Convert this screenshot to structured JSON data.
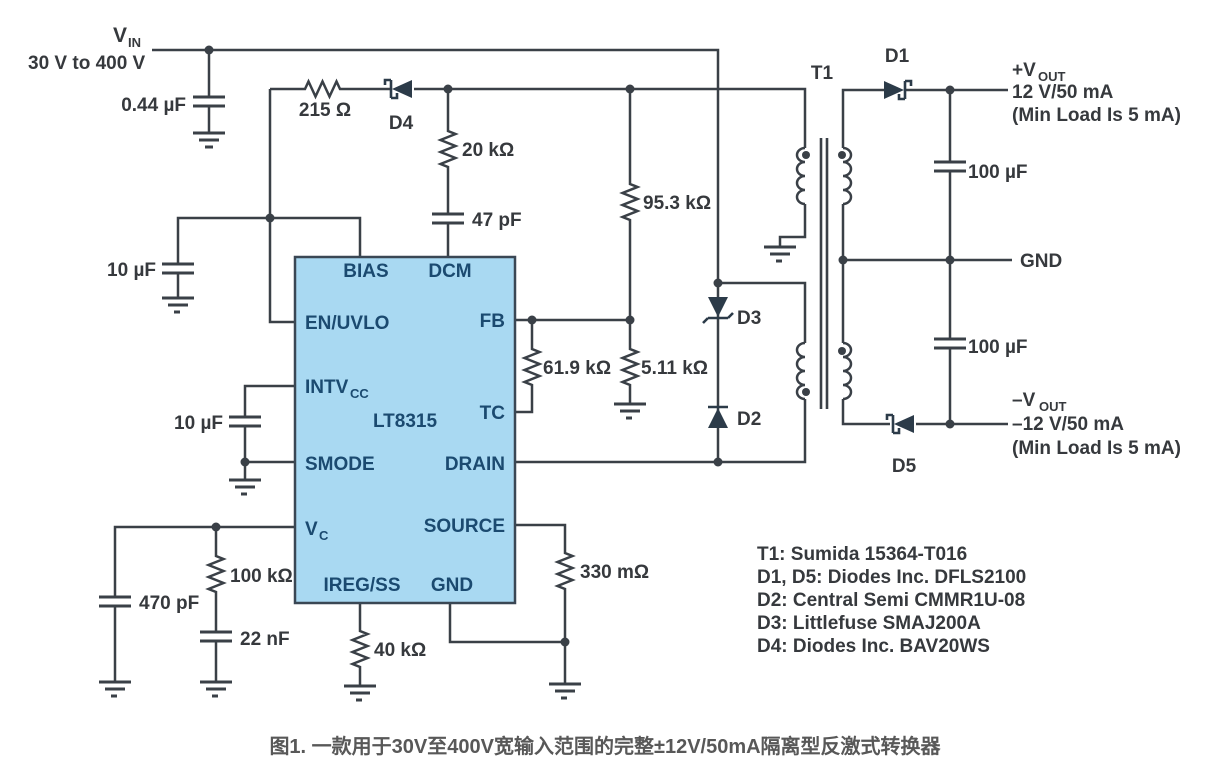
{
  "figure": {
    "caption": "图1. 一款用于30V至400V宽输入范围的完整±12V/50mA隔离型反激式转换器"
  },
  "input": {
    "vin_main": "V",
    "vin_sub": "IN",
    "vin_range": "30 V to 400 V"
  },
  "ic": {
    "part": "LT8315",
    "pins": {
      "bias": "BIAS",
      "dcm": "DCM",
      "en_uvlo": "EN/UVLO",
      "intvcc_main": "INTV",
      "intvcc_sub": "CC",
      "smode": "SMODE",
      "vc_main": "V",
      "vc_sub": "C",
      "ireg_ss": "IREG/SS",
      "gnd": "GND",
      "fb": "FB",
      "tc": "TC",
      "drain": "DRAIN",
      "source": "SOURCE"
    }
  },
  "components": {
    "c_in": "0.44 µF",
    "r_bias": "215 Ω",
    "d4": "D4",
    "r_dcm": "20 kΩ",
    "c_dcm": "47 pF",
    "r_fb_top": "95.3 kΩ",
    "c_bias": "10 µF",
    "c_intvcc": "10 µF",
    "r_tc": "61.9 kΩ",
    "r_fb_bot": "5.11 kΩ",
    "c_vc_hf": "470 pF",
    "r_vc": "100 kΩ",
    "c_vc": "22 nF",
    "r_ireg": "40 kΩ",
    "r_sense": "330 mΩ",
    "d3": "D3",
    "d2": "D2",
    "t1": "T1",
    "d1": "D1",
    "d5": "D5",
    "c_out_pos": "100 µF",
    "c_out_neg": "100 µF"
  },
  "outputs": {
    "pos": {
      "v_main": "+V",
      "v_sub": "OUT",
      "rating": "12 V/50 mA",
      "note": "(Min Load Is 5 mA)"
    },
    "gnd": "GND",
    "neg": {
      "v_main": "–V",
      "v_sub": "OUT",
      "rating": "–12 V/50 mA",
      "note": "(Min Load Is 5 mA)"
    }
  },
  "parts_list": {
    "t1": "T1: Sumida 15364-T016",
    "d1d5": "D1, D5: Diodes Inc. DFLS2100",
    "d2": "D2: Central Semi CMMR1U-08",
    "d3": "D3: Littlefuse SMAJ200A",
    "d4": "D4: Diodes Inc. BAV20WS"
  }
}
